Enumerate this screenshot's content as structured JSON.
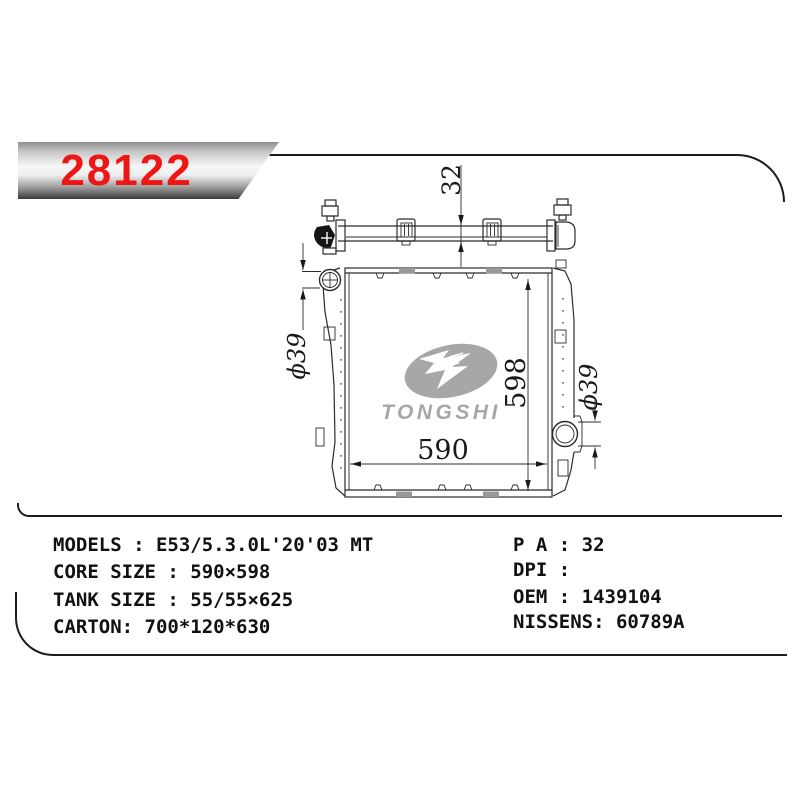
{
  "banner": {
    "part_number": "28122"
  },
  "drawing": {
    "dim_depth": "32",
    "dim_core_width": "590",
    "dim_core_height": "598",
    "dim_pipe_left": "ϕ39",
    "dim_pipe_right": "ϕ39",
    "logo": {
      "brand": "TONGSHI",
      "registered_mark": "®"
    }
  },
  "specs": {
    "left": [
      "MODELS : E53/5.3.0L'20'03 MT",
      "CORE SIZE : 590×598",
      "TANK SIZE : 55/55×625",
      "CARTON: 700*120*630"
    ],
    "right": [
      "P A : 32",
      "DPI :",
      "OEM : 1439104",
      "NISSENS: 60789A"
    ]
  },
  "colors": {
    "part_number_red": "#ee1515",
    "logo_gray": "#a7a7a7",
    "drawing_line": "#2b2b2b"
  }
}
